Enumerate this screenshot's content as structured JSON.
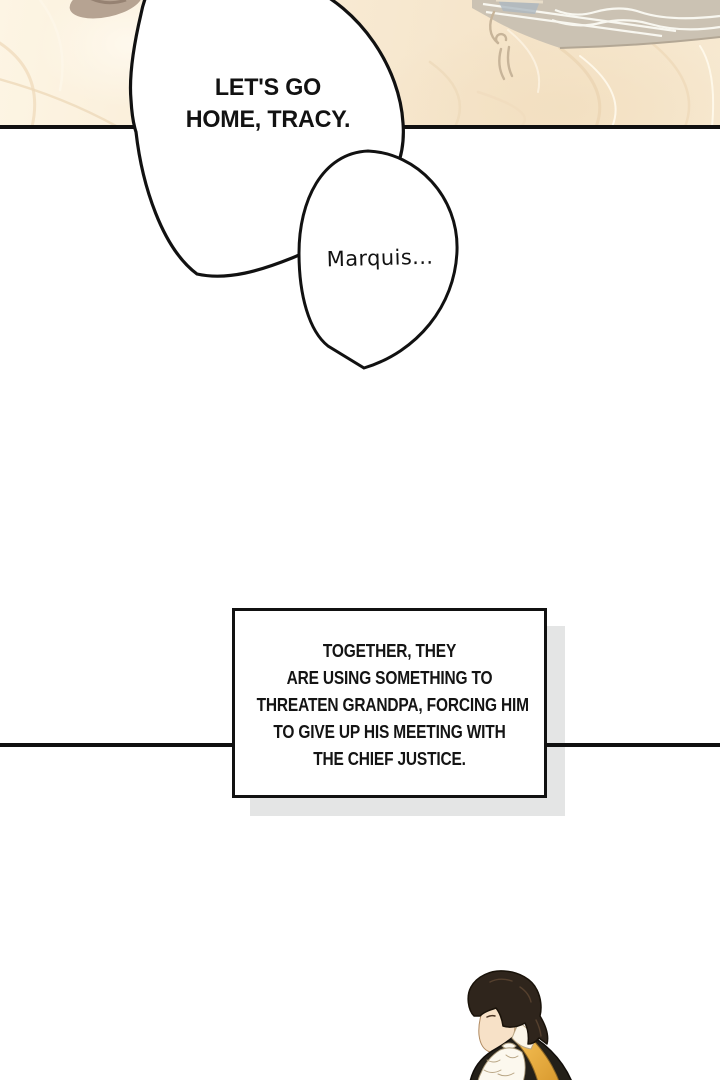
{
  "page": {
    "kind": "webtoon comic panel page",
    "background_color": "#ffffff",
    "divider_color": "#101010"
  },
  "bubbles": {
    "main": {
      "lines": [
        "LET'S GO",
        "HOME, TRACY."
      ],
      "fill": "#ffffff",
      "stroke": "#111111"
    },
    "small": {
      "text": "Marquis...",
      "fill": "#ffffff",
      "stroke": "#111111"
    }
  },
  "caption": {
    "lines": [
      "TOGETHER, THEY",
      "ARE USING SOMETHING TO",
      "THREATEN GRANDPA, FORCING HIM",
      "TO GIVE UP HIS MEETING WITH",
      "THE CHIEF JUSTICE."
    ],
    "border_color": "#111111",
    "shadow_color": "#e4e5e5"
  },
  "art": {
    "top_scene_alt": "faded cream scene: ornate vanity table edge with mirror glass and rumpled fabric folds",
    "palette": {
      "cream": "#f8ecd8",
      "fabric_shadow": "#eed9bb",
      "furniture_gray": "#cbc2b3",
      "mirror_glass": "#adb8c0",
      "outline_tan": "#c7b499",
      "blob_tan": "#b6a392"
    }
  },
  "character": {
    "alt": "dark-haired man in dark jacket with gold collar and white jabot, face turned left",
    "palette": {
      "hair": "#2f251c",
      "skin": "#f7e1c7",
      "jacket": "#242019",
      "gold": "#f0b445",
      "jabot": "#fcf8ee"
    }
  }
}
